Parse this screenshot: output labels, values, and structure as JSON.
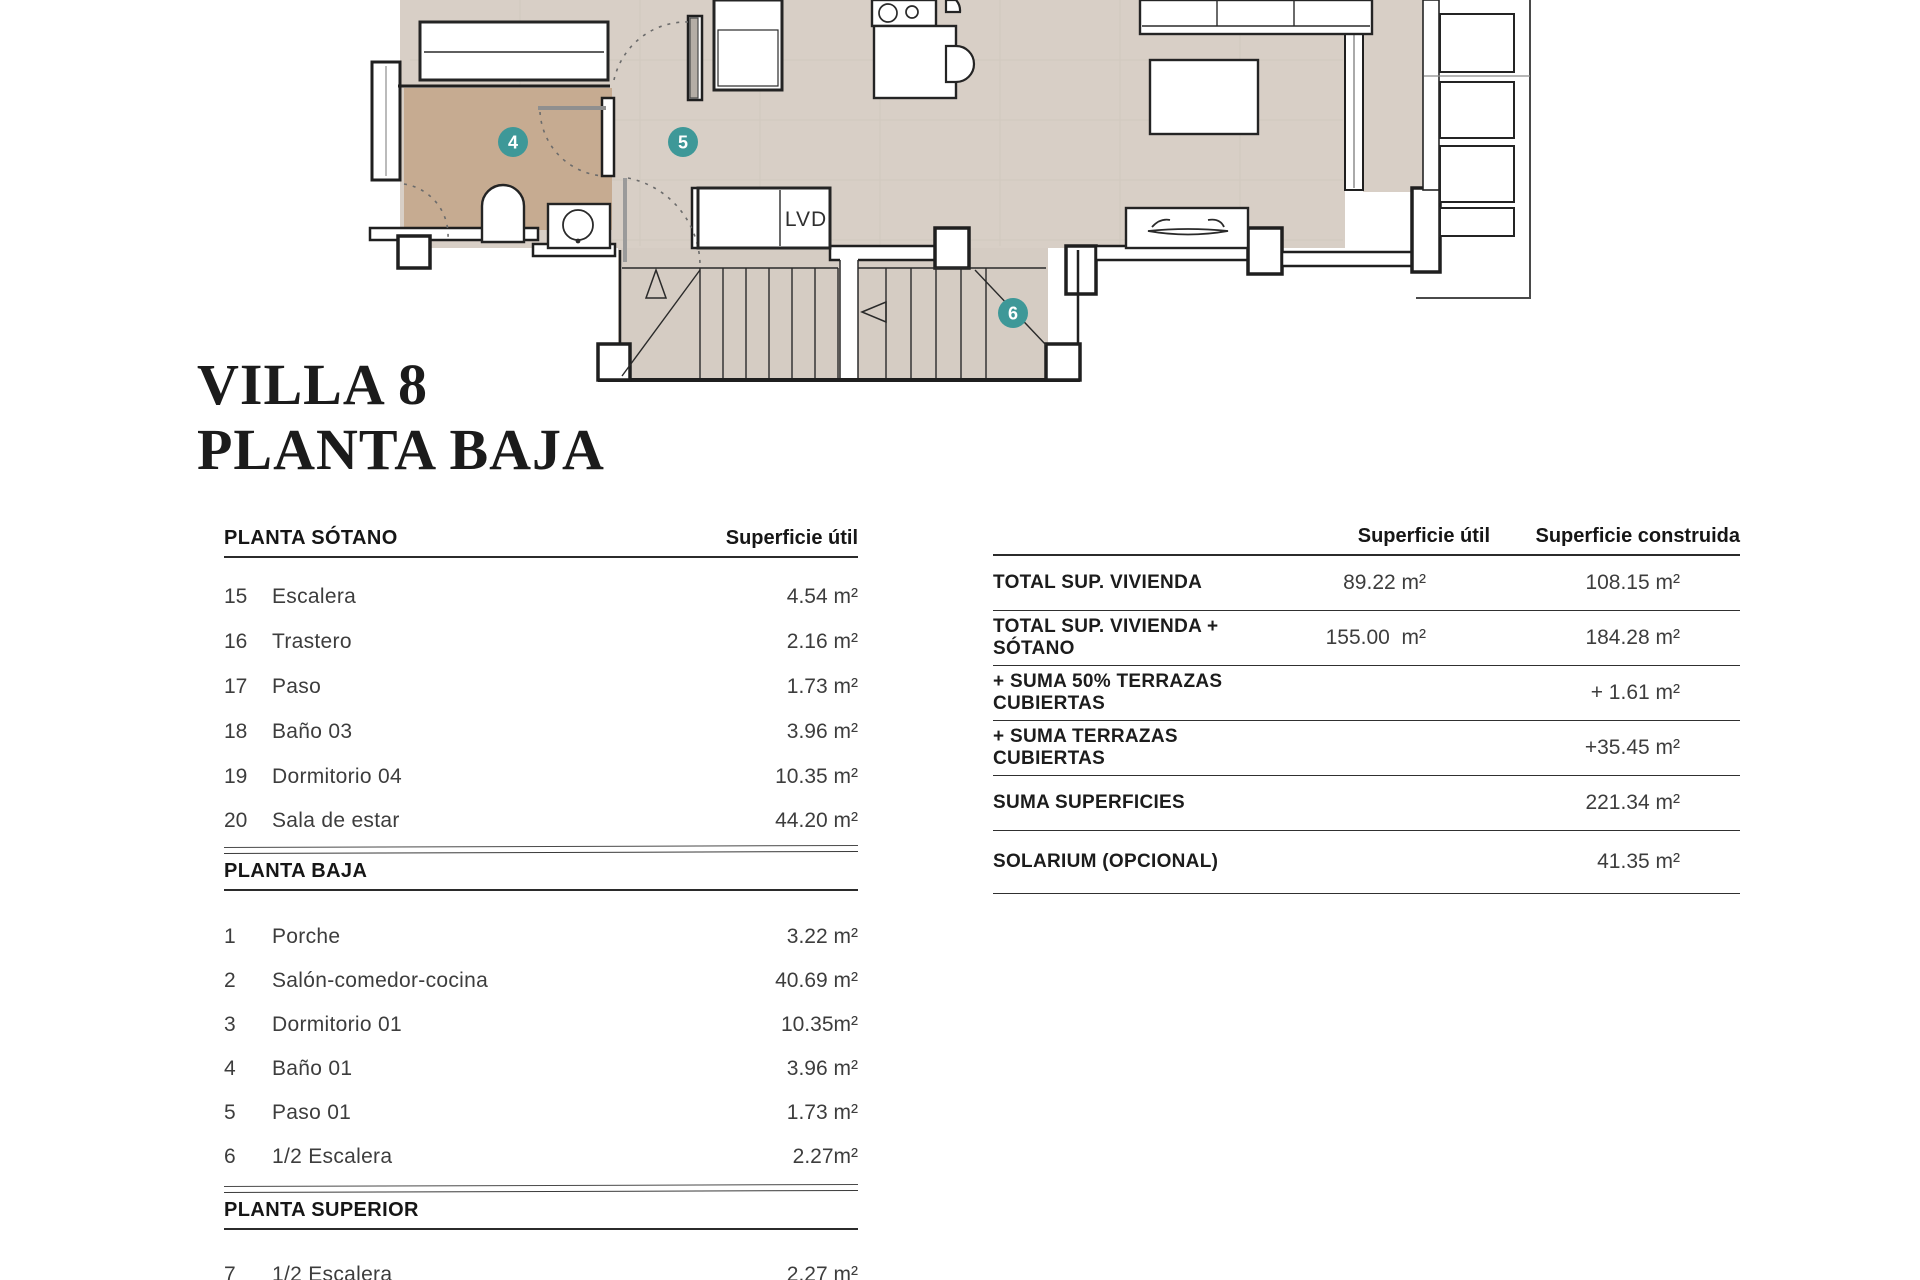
{
  "title": {
    "line1": "VILLA 8",
    "line2": "PLANTA BAJA"
  },
  "left_table": {
    "col_header": "Superficie útil",
    "sections": [
      {
        "header": "PLANTA SÓTANO",
        "rows": [
          {
            "num": "15",
            "name": "Escalera",
            "value": "4.54 m²"
          },
          {
            "num": "16",
            "name": "Trastero",
            "value": "2.16 m²"
          },
          {
            "num": "17",
            "name": "Paso",
            "value": "1.73 m²"
          },
          {
            "num": "18",
            "name": "Baño 03",
            "value": "3.96 m²"
          },
          {
            "num": "19",
            "name": "Dormitorio 04",
            "value": "10.35 m²"
          },
          {
            "num": "20",
            "name": "Sala de estar",
            "value": "44.20 m²"
          }
        ]
      },
      {
        "header": "PLANTA BAJA",
        "rows": [
          {
            "num": "1",
            "name": "Porche",
            "value": "3.22 m²"
          },
          {
            "num": "2",
            "name": "Salón-comedor-cocina",
            "value": "40.69 m²"
          },
          {
            "num": "3",
            "name": "Dormitorio 01",
            "value": "10.35m²"
          },
          {
            "num": "4",
            "name": "Baño 01",
            "value": "3.96 m²"
          },
          {
            "num": "5",
            "name": "Paso 01",
            "value": "1.73 m²"
          },
          {
            "num": "6",
            "name": "1/2 Escalera",
            "value": "2.27m²"
          }
        ]
      },
      {
        "header": "PLANTA SUPERIOR",
        "rows": [
          {
            "num": "7",
            "name": "1/2 Escalera",
            "value": "2.27 m²"
          }
        ]
      }
    ]
  },
  "right_table": {
    "col_headers": [
      "Superficie útil",
      "Superficie construida"
    ],
    "rows": [
      {
        "label": "TOTAL SUP. VIVIENDA",
        "util": "89.22 m²",
        "construida": "108.15 m²"
      },
      {
        "label": "TOTAL SUP. VIVIENDA + SÓTANO",
        "util": "155.00  m²",
        "construida": "184.28 m²"
      },
      {
        "label": "+ SUMA 50% TERRAZAS CUBIERTAS",
        "util": "",
        "construida": "+ 1.61 m²"
      },
      {
        "label": "+ SUMA TERRAZAS CUBIERTAS",
        "util": "",
        "construida": "+35.45 m²"
      },
      {
        "label": "SUMA SUPERFICIES",
        "util": "",
        "construida": "221.34 m²"
      },
      {
        "label": "SOLARIUM (OPCIONAL)",
        "util": "",
        "construida": "41.35 m²"
      }
    ]
  },
  "floor_plan": {
    "closet_label": "LVD",
    "markers": [
      {
        "label": "4"
      },
      {
        "label": "5"
      },
      {
        "label": "6"
      }
    ],
    "colors": {
      "floor": "#d8cfc6",
      "bathroom_floor": "#c6ab91",
      "stair_floor": "#d5ccc3",
      "wall_line": "#1f1f1f",
      "marker": "#3e9898"
    }
  }
}
